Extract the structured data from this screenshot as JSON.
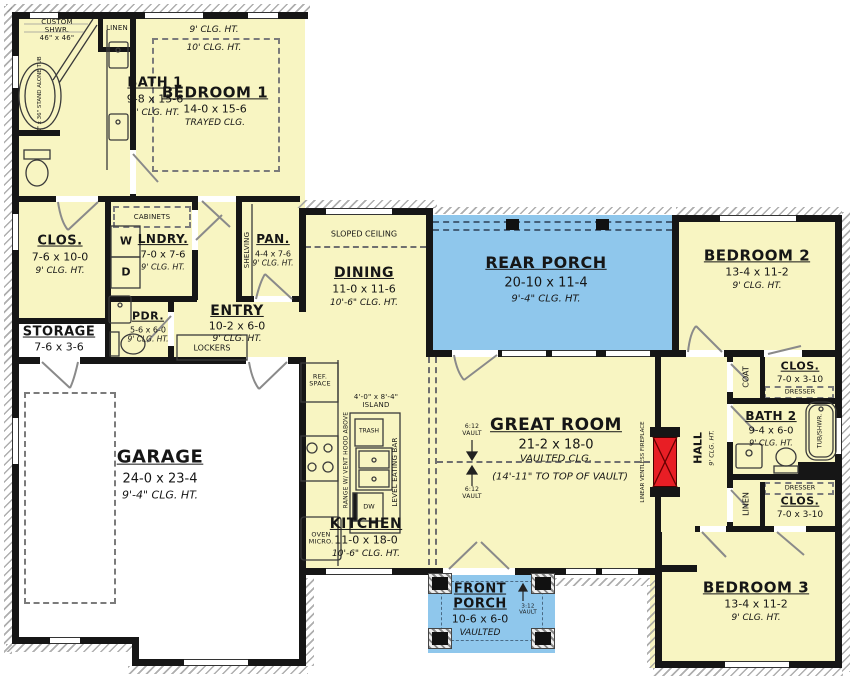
{
  "colors": {
    "room_fill": "#F8F5C2",
    "porch_fill": "#8FC7EC",
    "fireplace_red": "#E81E25",
    "wall": "#161616"
  },
  "rooms": {
    "bath1": {
      "name": "BATH 1",
      "dims": "9-8 x 15-6",
      "clg": "9' CLG. HT."
    },
    "linen1": {
      "name": "LINEN"
    },
    "shower": {
      "line1": "CUSTOM",
      "line2": "SHWR.",
      "line3": "46\" x 46\""
    },
    "tub1": {
      "label": "60\" x 36\" STAND ALONE TUB"
    },
    "bedroom1": {
      "name": "BEDROOM 1",
      "dims": "14-0 x 15-6",
      "clg": "TRAYED CLG.",
      "clg_outer": "9' CLG. HT.",
      "clg_inner": "10' CLG. HT."
    },
    "clos1": {
      "name": "CLOS.",
      "dims": "7-6 x 10-0",
      "clg": "9' CLG. HT."
    },
    "lndry": {
      "name": "LNDRY.",
      "dims": "7-0 x 7-6",
      "clg": "9' CLG. HT.",
      "cabinets": "CABINETS",
      "washer": "W",
      "dryer": "D"
    },
    "pan": {
      "name": "PAN.",
      "dims": "4-4 x 7-6",
      "clg": "9' CLG. HT.",
      "shelving": "SHELVING"
    },
    "entry": {
      "name": "ENTRY",
      "dims": "10-2 x 6-0",
      "clg": "9' CLG. HT.",
      "lockers": "LOCKERS"
    },
    "storage": {
      "name": "STORAGE",
      "dims": "7-6 x 3-6"
    },
    "pdr": {
      "name": "PDR.",
      "dims": "5-6 x 6-0",
      "clg": "9' CLG. HT."
    },
    "garage": {
      "name": "GARAGE",
      "dims": "24-0 x 23-4",
      "clg": "9'-4\" CLG. HT."
    },
    "dining": {
      "name": "DINING",
      "dims": "11-0 x 11-6",
      "clg": "10'-6\" CLG. HT.",
      "sloped": "SLOPED CEILING"
    },
    "kitchen": {
      "name": "KITCHEN",
      "dims": "11-0 x 18-0",
      "clg": "10'-6\" CLG. HT.",
      "ref1": "REF.",
      "ref2": "SPACE",
      "range1": "RANGE W/ VENT",
      "range2": "HOOD ABOVE",
      "oven1": "OVEN",
      "oven2": "MICRO.",
      "trash": "TRASH",
      "dw": "DW",
      "eating_bar": "LEVEL EATING BAR",
      "island_dims": "4'-0\" x 8'-4\"",
      "island": "ISLAND"
    },
    "great_room": {
      "name": "GREAT ROOM",
      "dims": "21-2 x 18-0",
      "clg": "VAULTED CLG.",
      "vault_note": "(14'-11\" TO TOP OF VAULT)",
      "vault_a1": "6:12",
      "vault_a2": "VAULT",
      "vault_b1": "6:12",
      "vault_b2": "VAULT"
    },
    "rear_porch": {
      "name": "REAR PORCH",
      "dims": "20-10 x 11-4",
      "clg": "9'-4\" CLG. HT."
    },
    "fireplace": {
      "line1": "LINEAR VENTLESS",
      "line2": "FIREPLACE"
    },
    "hall": {
      "name": "HALL",
      "clg": "9' CLG. HT."
    },
    "bedroom2": {
      "name": "BEDROOM 2",
      "dims": "13-4 x 11-2",
      "clg": "9' CLG. HT."
    },
    "coat": {
      "name": "COAT"
    },
    "clos2": {
      "name": "CLOS.",
      "dims": "7-0 x 3-10",
      "dresser": "DRESSER"
    },
    "bath2": {
      "name": "BATH 2",
      "dims": "9-4 x 6-0",
      "clg": "9' CLG. HT.",
      "tub": "TUB/SHWR."
    },
    "linen2": {
      "name": "LINEN"
    },
    "clos3": {
      "name": "CLOS.",
      "dims": "7-0 x 3-10",
      "dresser": "DRESSER"
    },
    "bedroom3": {
      "name": "BEDROOM 3",
      "dims": "13-4 x 11-2",
      "clg": "9' CLG. HT."
    },
    "front_porch": {
      "name1": "FRONT",
      "name2": "PORCH",
      "dims": "10-6 x 6-0",
      "clg": "VAULTED",
      "vault1": "3:12",
      "vault2": "VAULT"
    }
  }
}
